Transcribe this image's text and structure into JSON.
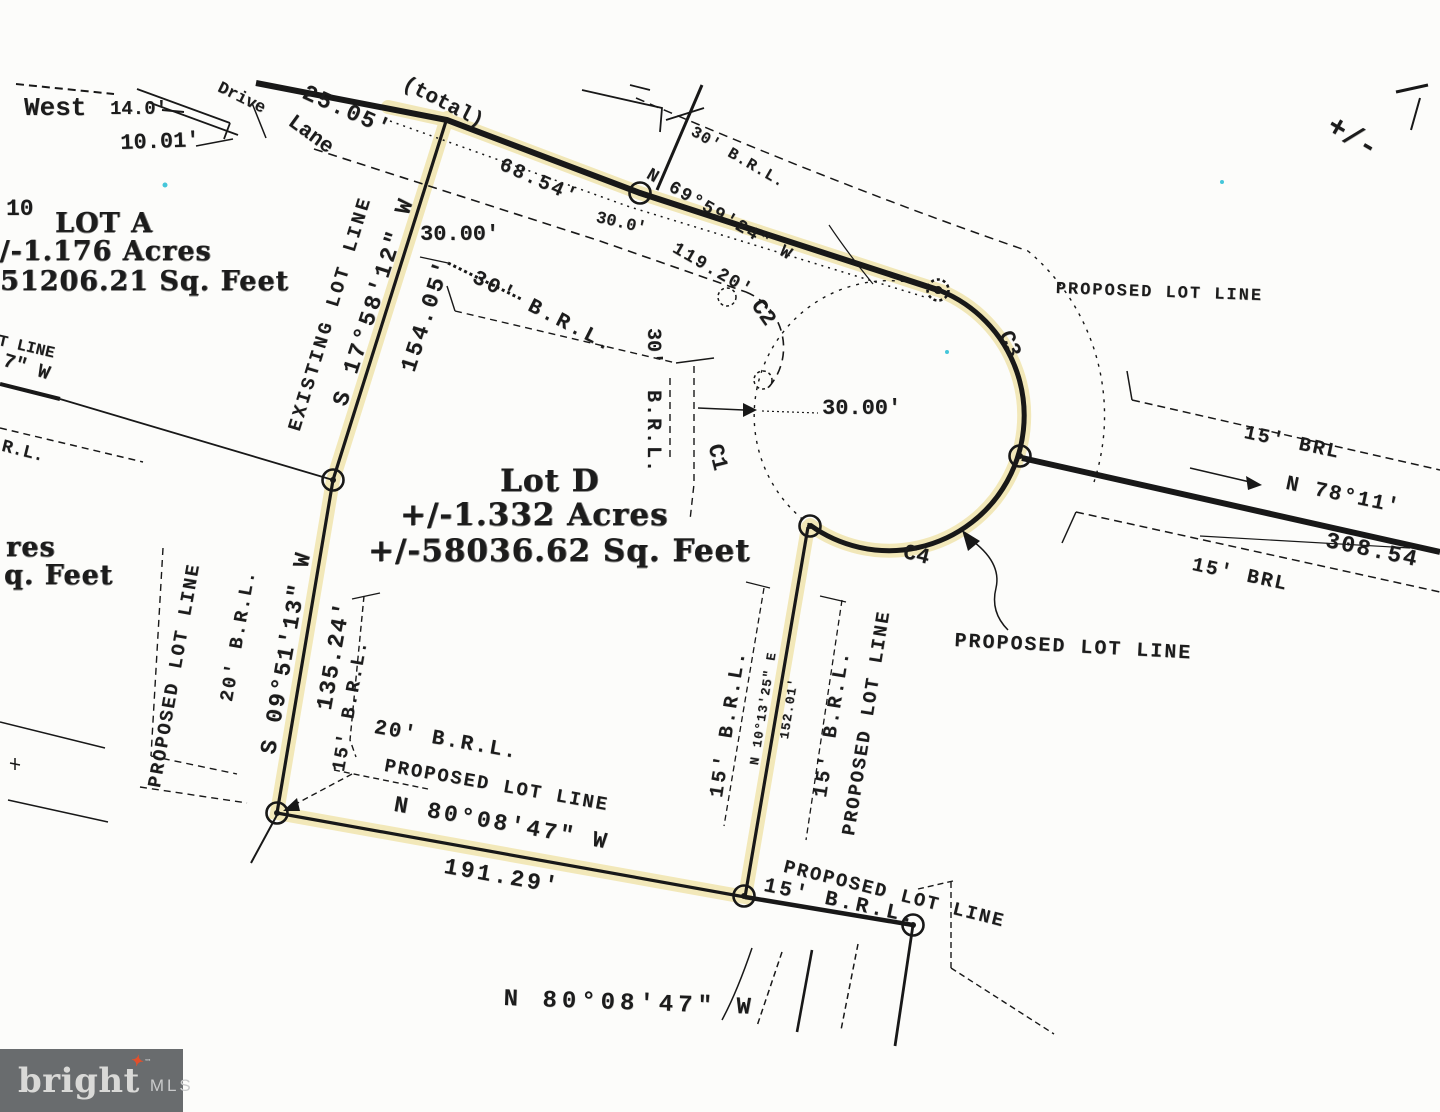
{
  "page": {
    "background": "#fcfcfa",
    "ink_color": "#1c1c1c",
    "highlight_color": "#eee0a0",
    "speck_color": "#45c6da"
  },
  "logo": {
    "brand": "bright",
    "suffix": "MLS",
    "tm": "™",
    "bg_color": "#696c6e",
    "text_color": "#d9d9d7",
    "suffix_color": "#c9cacb",
    "star_color": "#e2502c",
    "star_glyph": "✦"
  },
  "plat": {
    "lot_a": {
      "title": "LOT A",
      "acres": "+/-1.176 Acres",
      "sqft": "51206.21 Sq. Feet"
    },
    "lot_d": {
      "title": "Lot D",
      "acres": "+/-1.332 Acres",
      "sqft": "+/-58036.62 Sq. Feet"
    },
    "curves": [
      "C1",
      "C2",
      "C3",
      "C4"
    ],
    "labels": [
      {
        "name": "dim-west",
        "text": "West",
        "x": 24,
        "y": 95,
        "rot": 0,
        "size": 26,
        "font": "m"
      },
      {
        "name": "dim-14-0",
        "text": "14.0'",
        "x": 110,
        "y": 100,
        "rot": 0,
        "size": 19,
        "font": "m"
      },
      {
        "name": "dim-10-01",
        "text": "10.01'",
        "x": 120,
        "y": 133,
        "rot": -2,
        "size": 22,
        "font": "m"
      },
      {
        "name": "street-name-drive",
        "text": "Drive",
        "x": 222,
        "y": 80,
        "rot": 26,
        "size": 17,
        "font": "m"
      },
      {
        "name": "street-name-lane",
        "text": "Lane",
        "x": 296,
        "y": 112,
        "rot": 36,
        "size": 21,
        "font": "m"
      },
      {
        "name": "dim-25-05",
        "text": "25.05'",
        "x": 308,
        "y": 82,
        "rot": 24,
        "size": 23,
        "font": "m",
        "ls": 2
      },
      {
        "name": "dim-total",
        "text": "(total)",
        "x": 408,
        "y": 74,
        "rot": 27,
        "size": 21,
        "font": "m"
      },
      {
        "name": "lot-number-10",
        "text": "10",
        "x": 6,
        "y": 198,
        "rot": 0,
        "size": 23,
        "font": "m"
      },
      {
        "name": "lot-a-title",
        "text": "LOT A",
        "x": 55,
        "y": 210,
        "rot": 0,
        "size": 27,
        "font": "s"
      },
      {
        "name": "lot-a-acres",
        "text": "+/-1.176 Acres",
        "x": -24,
        "y": 238,
        "rot": 0,
        "size": 27,
        "font": "s"
      },
      {
        "name": "lot-a-sqft",
        "text": "51206.21 Sq. Feet",
        "x": 0,
        "y": 268,
        "rot": 0,
        "size": 27,
        "font": "s"
      },
      {
        "name": "edge-lot-line-partial",
        "text": "T LINE",
        "x": 0,
        "y": 333,
        "rot": 13,
        "size": 16,
        "font": "m"
      },
      {
        "name": "edge-bearing-partial",
        "text": "7\" W",
        "x": 6,
        "y": 352,
        "rot": 17,
        "size": 20,
        "font": "m"
      },
      {
        "name": "edge-brl-partial",
        "text": "R.L.",
        "x": 4,
        "y": 438,
        "rot": 14,
        "size": 18,
        "font": "m"
      },
      {
        "name": "existing-lot-line-label",
        "text": "EXISTING LOT LINE",
        "x": 286,
        "y": 428,
        "rot": -73,
        "size": 19,
        "font": "m",
        "ls": 3
      },
      {
        "name": "bearing-s17",
        "text": "S 17°58'12\" W",
        "x": 330,
        "y": 402,
        "rot": -72,
        "size": 23,
        "font": "m",
        "ls": 3
      },
      {
        "name": "dim-154-05",
        "text": "154.05'",
        "x": 398,
        "y": 368,
        "rot": -72,
        "size": 23,
        "font": "m",
        "ls": 3
      },
      {
        "name": "dim-30-00-top",
        "text": "30.00'",
        "x": 420,
        "y": 224,
        "rot": 0,
        "size": 22,
        "font": "m"
      },
      {
        "name": "brl-30-mid",
        "text": "30' B.R.L.",
        "x": 478,
        "y": 268,
        "rot": 27,
        "size": 21,
        "font": "m",
        "ls": 3
      },
      {
        "name": "dim-68-54",
        "text": "68.54'",
        "x": 504,
        "y": 156,
        "rot": 24,
        "size": 20,
        "font": "m",
        "ls": 2
      },
      {
        "name": "dim-30-0",
        "text": "30.0'",
        "x": 598,
        "y": 210,
        "rot": 13,
        "size": 17,
        "font": "m"
      },
      {
        "name": "bearing-n69",
        "text": "N 69°59'24\" W",
        "x": 652,
        "y": 166,
        "rot": 30,
        "size": 18,
        "font": "m",
        "ls": 2
      },
      {
        "name": "dim-119-20",
        "text": "119.20'",
        "x": 678,
        "y": 240,
        "rot": 30,
        "size": 18,
        "font": "m",
        "ls": 2
      },
      {
        "name": "brl-30-top",
        "text": "30' B.R.L.",
        "x": 696,
        "y": 124,
        "rot": 30,
        "size": 16,
        "font": "m",
        "ls": 1
      },
      {
        "name": "proposed-lot-line-ne",
        "text": "PROPOSED LOT LINE",
        "x": 1056,
        "y": 281,
        "rot": 2,
        "size": 17,
        "font": "m",
        "ls": 2
      },
      {
        "name": "curve-c3",
        "text": "C3",
        "x": 1014,
        "y": 328,
        "rot": 68,
        "size": 22,
        "font": "m"
      },
      {
        "name": "plus-minus-partial",
        "text": "+/-",
        "x": 1336,
        "y": 112,
        "rot": 30,
        "size": 30,
        "font": "m"
      },
      {
        "name": "brl-15-east-upper",
        "text": "15' BRL",
        "x": 1246,
        "y": 424,
        "rot": 12,
        "size": 20,
        "font": "m",
        "ls": 2
      },
      {
        "name": "bearing-n78",
        "text": "N 78°11'",
        "x": 1288,
        "y": 474,
        "rot": 12,
        "size": 21,
        "font": "m",
        "ls": 2
      },
      {
        "name": "dim-308-54",
        "text": "308.54",
        "x": 1328,
        "y": 530,
        "rot": 12,
        "size": 23,
        "font": "m",
        "ls": 2
      },
      {
        "name": "brl-15-east-lower",
        "text": "15' BRL",
        "x": 1194,
        "y": 556,
        "rot": 12,
        "size": 20,
        "font": "m",
        "ls": 2
      },
      {
        "name": "lot-d-title",
        "text": "Lot D",
        "x": 500,
        "y": 466,
        "rot": 0,
        "size": 31,
        "font": "s"
      },
      {
        "name": "lot-d-acres",
        "text": "+/-1.332 Acres",
        "x": 400,
        "y": 500,
        "rot": 0,
        "size": 31,
        "font": "s"
      },
      {
        "name": "lot-d-sqft",
        "text": "+/-58036.62 Sq. Feet",
        "x": 368,
        "y": 536,
        "rot": 0,
        "size": 31,
        "font": "s"
      },
      {
        "name": "edge-acres-partial",
        "text": "res",
        "x": 6,
        "y": 534,
        "rot": 0,
        "size": 27,
        "font": "s"
      },
      {
        "name": "edge-sqft-partial",
        "text": "q. Feet",
        "x": 4,
        "y": 562,
        "rot": 0,
        "size": 27,
        "font": "s"
      },
      {
        "name": "brl-30-vert-num",
        "text": "30'",
        "x": 662,
        "y": 328,
        "rot": 90,
        "size": 20,
        "font": "m"
      },
      {
        "name": "brl-30-vert",
        "text": "B.R.L.",
        "x": 662,
        "y": 390,
        "rot": 90,
        "size": 20,
        "font": "m",
        "ls": 2
      },
      {
        "name": "dim-30-00-culdesac",
        "text": "30.00'",
        "x": 822,
        "y": 398,
        "rot": 0,
        "size": 22,
        "font": "m"
      },
      {
        "name": "curve-c1",
        "text": "C1",
        "x": 724,
        "y": 442,
        "rot": 76,
        "size": 22,
        "font": "m"
      },
      {
        "name": "curve-c2",
        "text": "C2",
        "x": 764,
        "y": 296,
        "rot": 55,
        "size": 22,
        "font": "m"
      },
      {
        "name": "curve-c4",
        "text": "C4",
        "x": 906,
        "y": 542,
        "rot": 14,
        "size": 22,
        "font": "m"
      },
      {
        "name": "proposed-lot-line-se",
        "text": "PROPOSED LOT LINE",
        "x": 955,
        "y": 632,
        "rot": 3,
        "size": 20,
        "font": "m",
        "ls": 2
      },
      {
        "name": "proposed-lot-line-w",
        "text": "PROPOSED LOT LINE",
        "x": 146,
        "y": 786,
        "rot": -80,
        "size": 19,
        "font": "m",
        "ls": 2
      },
      {
        "name": "brl-20-w",
        "text": "20' B.R.L.",
        "x": 218,
        "y": 700,
        "rot": -80,
        "size": 19,
        "font": "m",
        "ls": 2
      },
      {
        "name": "bearing-s09",
        "text": "S 09°51'13\" W",
        "x": 258,
        "y": 752,
        "rot": -80,
        "size": 23,
        "font": "m",
        "ls": 2
      },
      {
        "name": "dim-135-24",
        "text": "135.24'",
        "x": 314,
        "y": 708,
        "rot": -80,
        "size": 23,
        "font": "m",
        "ls": 2
      },
      {
        "name": "brl-15-sw",
        "text": "15' B.R.L.",
        "x": 330,
        "y": 770,
        "rot": -80,
        "size": 19,
        "font": "m",
        "ls": 2
      },
      {
        "name": "brl-20-s",
        "text": "20' B.R.L.",
        "x": 376,
        "y": 718,
        "rot": 10,
        "size": 21,
        "font": "m",
        "ls": 2
      },
      {
        "name": "proposed-lot-line-s",
        "text": "PROPOSED LOT LINE",
        "x": 386,
        "y": 757,
        "rot": 10,
        "size": 19,
        "font": "m",
        "ls": 2
      },
      {
        "name": "bearing-n80-s",
        "text": "N 80°08'47\" W",
        "x": 396,
        "y": 794,
        "rot": 10,
        "size": 23,
        "font": "m",
        "ls": 3
      },
      {
        "name": "dim-191-29",
        "text": "191.29'",
        "x": 446,
        "y": 856,
        "rot": 10,
        "size": 23,
        "font": "m",
        "ls": 3
      },
      {
        "name": "brl-15-e-inner",
        "text": "15' B.R.L.",
        "x": 708,
        "y": 796,
        "rot": -81,
        "size": 20,
        "font": "m",
        "ls": 3
      },
      {
        "name": "bearing-n10",
        "text": "N 10°13'25\" E",
        "x": 748,
        "y": 764,
        "rot": -81,
        "size": 13,
        "font": "m",
        "ls": 1
      },
      {
        "name": "dim-152-01",
        "text": "152.01'",
        "x": 778,
        "y": 738,
        "rot": -81,
        "size": 13,
        "font": "m",
        "ls": 1
      },
      {
        "name": "brl-15-e-outer",
        "text": "15' B.R.L.",
        "x": 812,
        "y": 796,
        "rot": -81,
        "size": 20,
        "font": "m",
        "ls": 3
      },
      {
        "name": "proposed-lot-line-e",
        "text": "PROPOSED LOT LINE",
        "x": 840,
        "y": 834,
        "rot": -81,
        "size": 19,
        "font": "m",
        "ls": 2
      },
      {
        "name": "proposed-lot-line-br",
        "text": "PROPOSED LOT LINE",
        "x": 786,
        "y": 858,
        "rot": 14,
        "size": 19,
        "font": "m",
        "ls": 2
      },
      {
        "name": "brl-15-br",
        "text": "15' B.R.L.",
        "x": 766,
        "y": 876,
        "rot": 12,
        "size": 21,
        "font": "m",
        "ls": 3
      },
      {
        "name": "bearing-n80-bottom",
        "text": "N 80°08'47\" W",
        "x": 504,
        "y": 988,
        "rot": 2,
        "size": 24,
        "font": "m",
        "ls": 5
      }
    ]
  }
}
